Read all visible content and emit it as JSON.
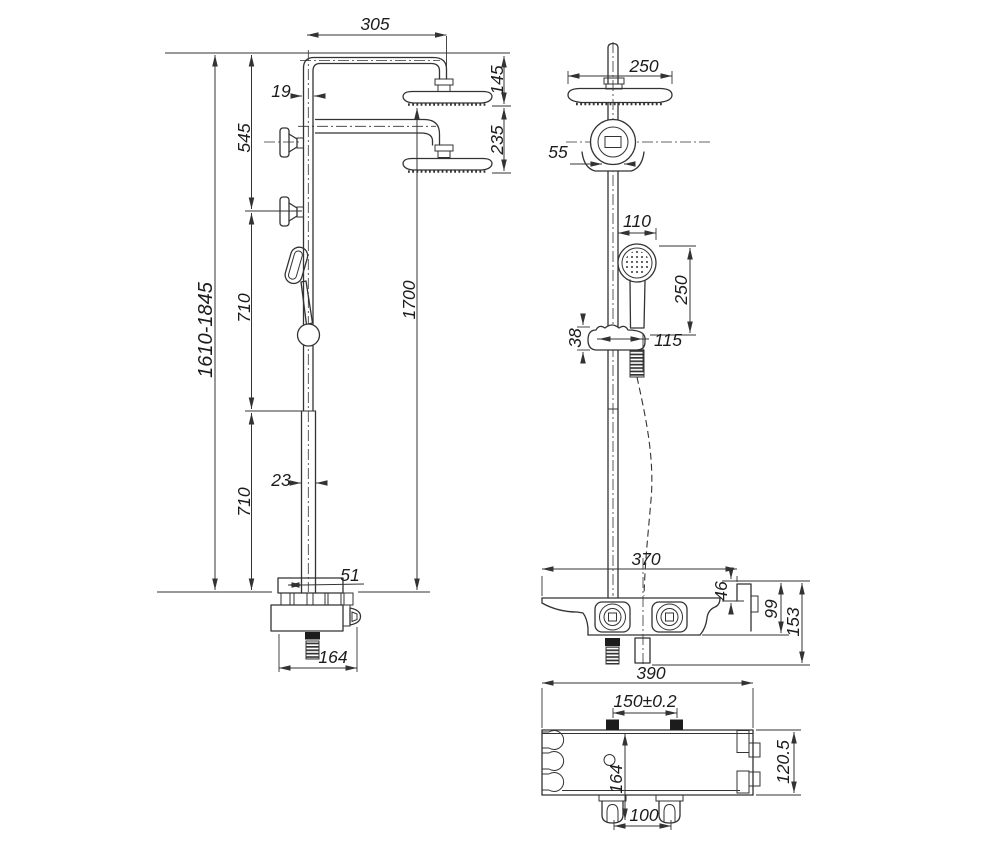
{
  "drawing": {
    "background": "#ffffff",
    "line_color": "#333333",
    "views": {
      "front_view": {
        "dims": {
          "arm_reach": "305",
          "upper_pipe_diameter": "19",
          "top_to_lower_bracket": "545",
          "bracket_to_joint": "710",
          "joint_to_mixer": "710",
          "overall_height_range": "1610-1845",
          "lower_pipe_diameter": "23",
          "mixer_shelf_depth": "51",
          "mixer_width": "164",
          "head_to_mixer": "1700",
          "top_to_head": "145",
          "head_travel": "235"
        }
      },
      "side_view": {
        "dims": {
          "head_diameter": "250",
          "wall_bracket_width": "55",
          "handshower_diameter": "110",
          "handshower_length": "250",
          "holder_height": "38",
          "holder_reach": "115",
          "mixer_top_width": "370",
          "hook_height": "46",
          "mixer_depth": "99",
          "mixer_total_depth": "153"
        }
      },
      "bottom_view": {
        "dims": {
          "mixer_body_width": "390",
          "inlet_spacing": "150±0.2",
          "mount_offset": "164",
          "foot_hole_spacing": "100",
          "mixer_body_height": "120.5"
        }
      }
    }
  }
}
